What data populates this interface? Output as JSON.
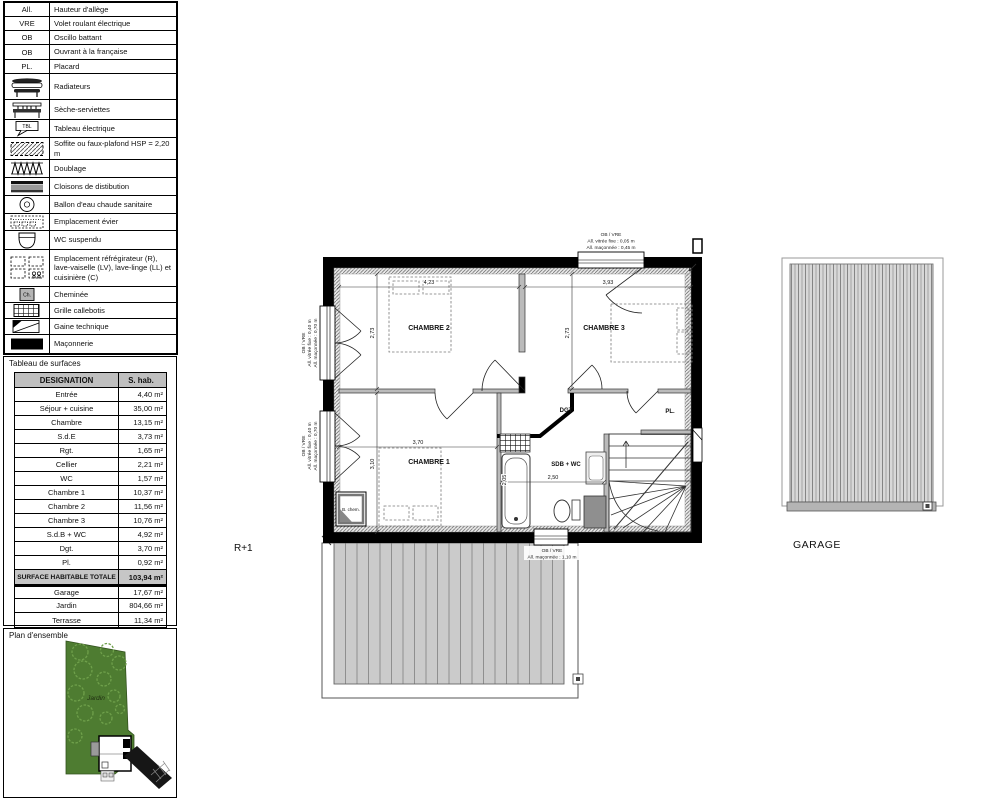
{
  "legend": {
    "rows": [
      {
        "abbr": "All.",
        "label": "Hauteur d'allège"
      },
      {
        "abbr": "VRE",
        "label": "Volet roulant électrique"
      },
      {
        "abbr": "OB",
        "label": "Oscillo battant"
      },
      {
        "abbr": "OB",
        "label": "Ouvrant à la française"
      },
      {
        "abbr": "PL.",
        "label": "Placard"
      },
      {
        "icon": "radiator-icon",
        "label": "Radiateurs"
      },
      {
        "icon": "towel-radiator-icon",
        "label": "Sèche-serviettes"
      },
      {
        "icon": "electrical-panel-icon",
        "icon_text": "TBL",
        "label": "Tableau électrique"
      },
      {
        "icon": "soffit-hatch-icon",
        "label": "Soffite ou faux-plafond HSP = 2,20 m"
      },
      {
        "icon": "insulation-icon",
        "label": "Doublage"
      },
      {
        "icon": "partition-icon",
        "label": "Cloisons de distibution"
      },
      {
        "icon": "water-heater-icon",
        "label": "Ballon d'eau chaude sanitaire"
      },
      {
        "icon": "sink-location-icon",
        "label": "Emplacement évier"
      },
      {
        "icon": "wall-hung-wc-icon",
        "label": "WC suspendu"
      },
      {
        "icon": "appliances-icon",
        "label": "Emplacement réfrégirateur (R), lave-vaiselle (LV), lave-linge (LL) et cuisinière (C)"
      },
      {
        "icon": "chimney-icon",
        "icon_text": "Ch.",
        "label": "Cheminée"
      },
      {
        "icon": "grating-icon",
        "label": "Grille callebotis"
      },
      {
        "icon": "technical-duct-icon",
        "label": "Gaine technique"
      },
      {
        "icon": "masonry-icon",
        "label": "Maçonnerie"
      }
    ]
  },
  "surface_table": {
    "title": "Tableau de surfaces",
    "headers": {
      "designation": "DESIGNATION",
      "surface": "S. hab."
    },
    "rows": [
      {
        "name": "Entrée",
        "value": "4,40  m²"
      },
      {
        "name": "Séjour + cuisine",
        "value": "35,00  m²"
      },
      {
        "name": "Chambre",
        "value": "13,15  m²"
      },
      {
        "name": "S.d.E",
        "value": "3,73  m²"
      },
      {
        "name": "Rgt.",
        "value": "1,65  m²"
      },
      {
        "name": "Cellier",
        "value": "2,21  m²"
      },
      {
        "name": "WC",
        "value": "1,57  m²"
      },
      {
        "name": "Chambre 1",
        "value": "10,37  m²"
      },
      {
        "name": "Chambre 2",
        "value": "11,56  m²"
      },
      {
        "name": "Chambre 3",
        "value": "10,76  m²"
      },
      {
        "name": "S.d.B + WC",
        "value": "4,92  m²"
      },
      {
        "name": "Dgt.",
        "value": "3,70  m²"
      },
      {
        "name": "Pl.",
        "value": "0,92  m²"
      }
    ],
    "total": {
      "name": "SURFACE HABITABLE TOTALE",
      "value": "103,94 m²"
    },
    "extra_rows": [
      {
        "name": "Garage",
        "value": "17,67  m²"
      },
      {
        "name": "Jardin",
        "value": "804,66  m²"
      },
      {
        "name": "Terrasse",
        "value": "11,34  m²"
      }
    ]
  },
  "site_plan": {
    "title": "Plan d'ensemble",
    "garden_label": "Jardin",
    "garden_color": "#4e7c31",
    "tree_color": "#6fa04b"
  },
  "floor_plan": {
    "level_label": "R+1",
    "rooms": {
      "chambre1": "CHAMBRE 1",
      "chambre2": "CHAMBRE 2",
      "chambre3": "CHAMBRE 3",
      "sdb": "SDB + WC",
      "dgt": "DGT",
      "placard": "PL.",
      "chimney_box": "B. chem."
    },
    "dimensions": {
      "chambre2_width": "4,23",
      "chambre2_depth": "2,73",
      "chambre3_width": "3,93",
      "chambre3_depth": "2,73",
      "chambre1_width": "3,70",
      "chambre1_depth": "3,10",
      "sdb_width": "2,50",
      "sdb_depth": "2,05"
    },
    "annotations": {
      "top_window": [
        "OB / VRE",
        "All. vitrée fixe : 0,05 m",
        "All. maçonnée : 0,45 m"
      ],
      "left_window_upper": [
        "OB / VRE",
        "All. vitrée fixe : 0,40 m",
        "All. maçonnée : 0,70 m"
      ],
      "left_window_lower": [
        "OB / VRE",
        "All. vitrée fixe : 0,40 m",
        "All. maçonnée : 0,70 m"
      ],
      "bottom_window": [
        "OB / VRE",
        "All. maçonnée : 1,10 m"
      ]
    }
  },
  "garage": {
    "label": "GARAGE"
  }
}
